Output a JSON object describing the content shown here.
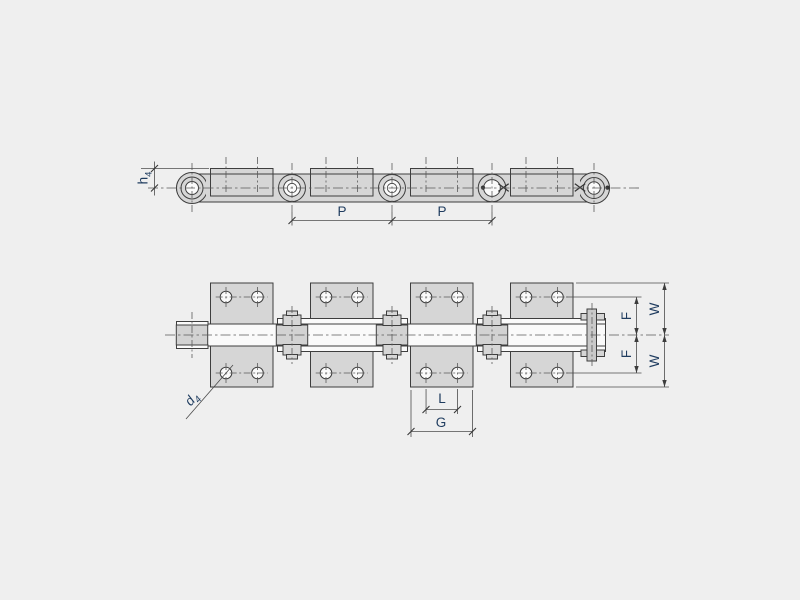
{
  "labels": {
    "p1": "P",
    "p2": "P",
    "h4": {
      "main": "h",
      "sub": "4"
    },
    "d4": {
      "main": "d",
      "sub": "4"
    },
    "l": "L",
    "g": "G",
    "f_top": "F",
    "f_bottom": "F",
    "w_top": "W",
    "w_bottom": "W"
  },
  "colors": {
    "background": "#efefef",
    "part_fill": "#d6d6d6",
    "inner_fill": "#fafafa",
    "line": "#3e3e3e",
    "label_text": "#1f3c5f"
  }
}
